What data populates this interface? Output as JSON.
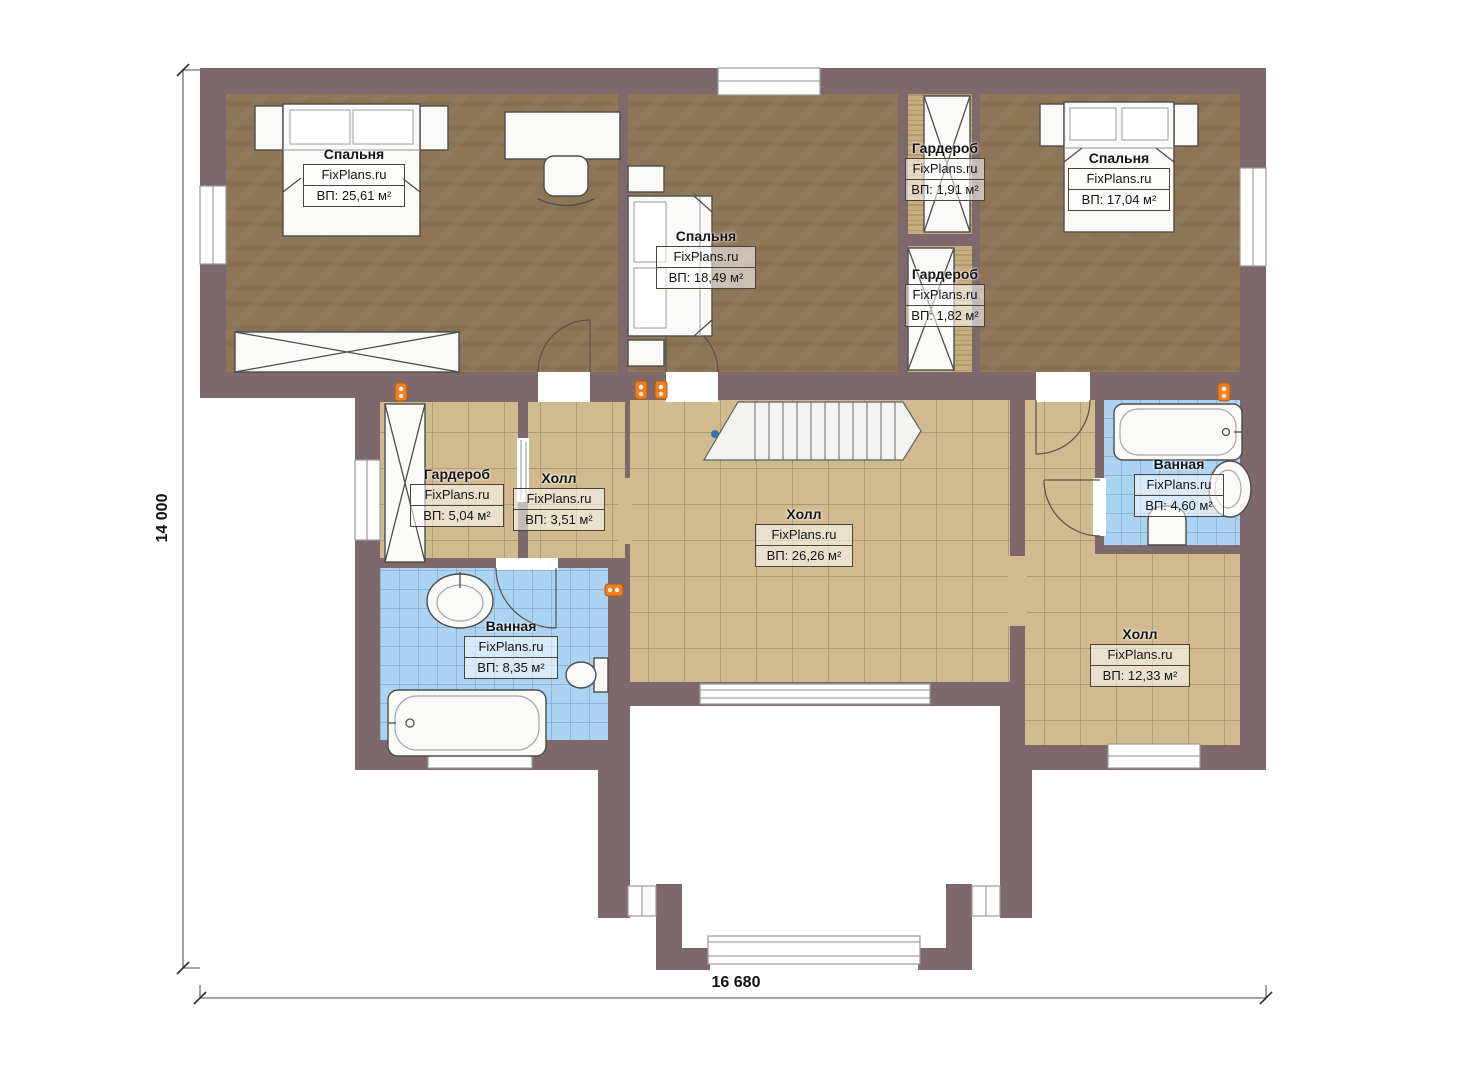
{
  "plan": {
    "brand": "FixPlans.ru",
    "dimensions": {
      "height": "14 000",
      "width": "16 680"
    },
    "rooms": [
      {
        "id": "bedroom-1",
        "name": "Спальня",
        "brand": "FixPlans.ru",
        "area": "ВП: 25,61 м²"
      },
      {
        "id": "bedroom-2",
        "name": "Спальня",
        "brand": "FixPlans.ru",
        "area": "ВП: 18,49 м²"
      },
      {
        "id": "wardrobe-1",
        "name": "Гардероб",
        "brand": "FixPlans.ru",
        "area": "ВП: 1,91 м²"
      },
      {
        "id": "bedroom-3",
        "name": "Спальня",
        "brand": "FixPlans.ru",
        "area": "ВП: 17,04 м²"
      },
      {
        "id": "wardrobe-2",
        "name": "Гардероб",
        "brand": "FixPlans.ru",
        "area": "ВП: 1,82 м²"
      },
      {
        "id": "wardrobe-3",
        "name": "Гардероб",
        "brand": "FixPlans.ru",
        "area": "ВП: 5,04 м²"
      },
      {
        "id": "hall-small",
        "name": "Холл",
        "brand": "FixPlans.ru",
        "area": "ВП: 3,51 м²"
      },
      {
        "id": "hall-main",
        "name": "Холл",
        "brand": "FixPlans.ru",
        "area": "ВП: 26,26 м²"
      },
      {
        "id": "bathroom-right",
        "name": "Ванная",
        "brand": "FixPlans.ru",
        "area": "ВП: 4,60 м²"
      },
      {
        "id": "bathroom-left",
        "name": "Ванная",
        "brand": "FixPlans.ru",
        "area": "ВП: 8,35 м²"
      },
      {
        "id": "hall-right",
        "name": "Холл",
        "brand": "FixPlans.ru",
        "area": "ВП: 12,33 м²"
      }
    ],
    "colors": {
      "wall": "#7d686b",
      "wood": "#8d7555",
      "tile": "#d1bb8e",
      "blue": "#abd3f2",
      "fixture": "#fafaf8",
      "outline": "#4d4d4d",
      "lamp": "#ee7e22"
    }
  }
}
